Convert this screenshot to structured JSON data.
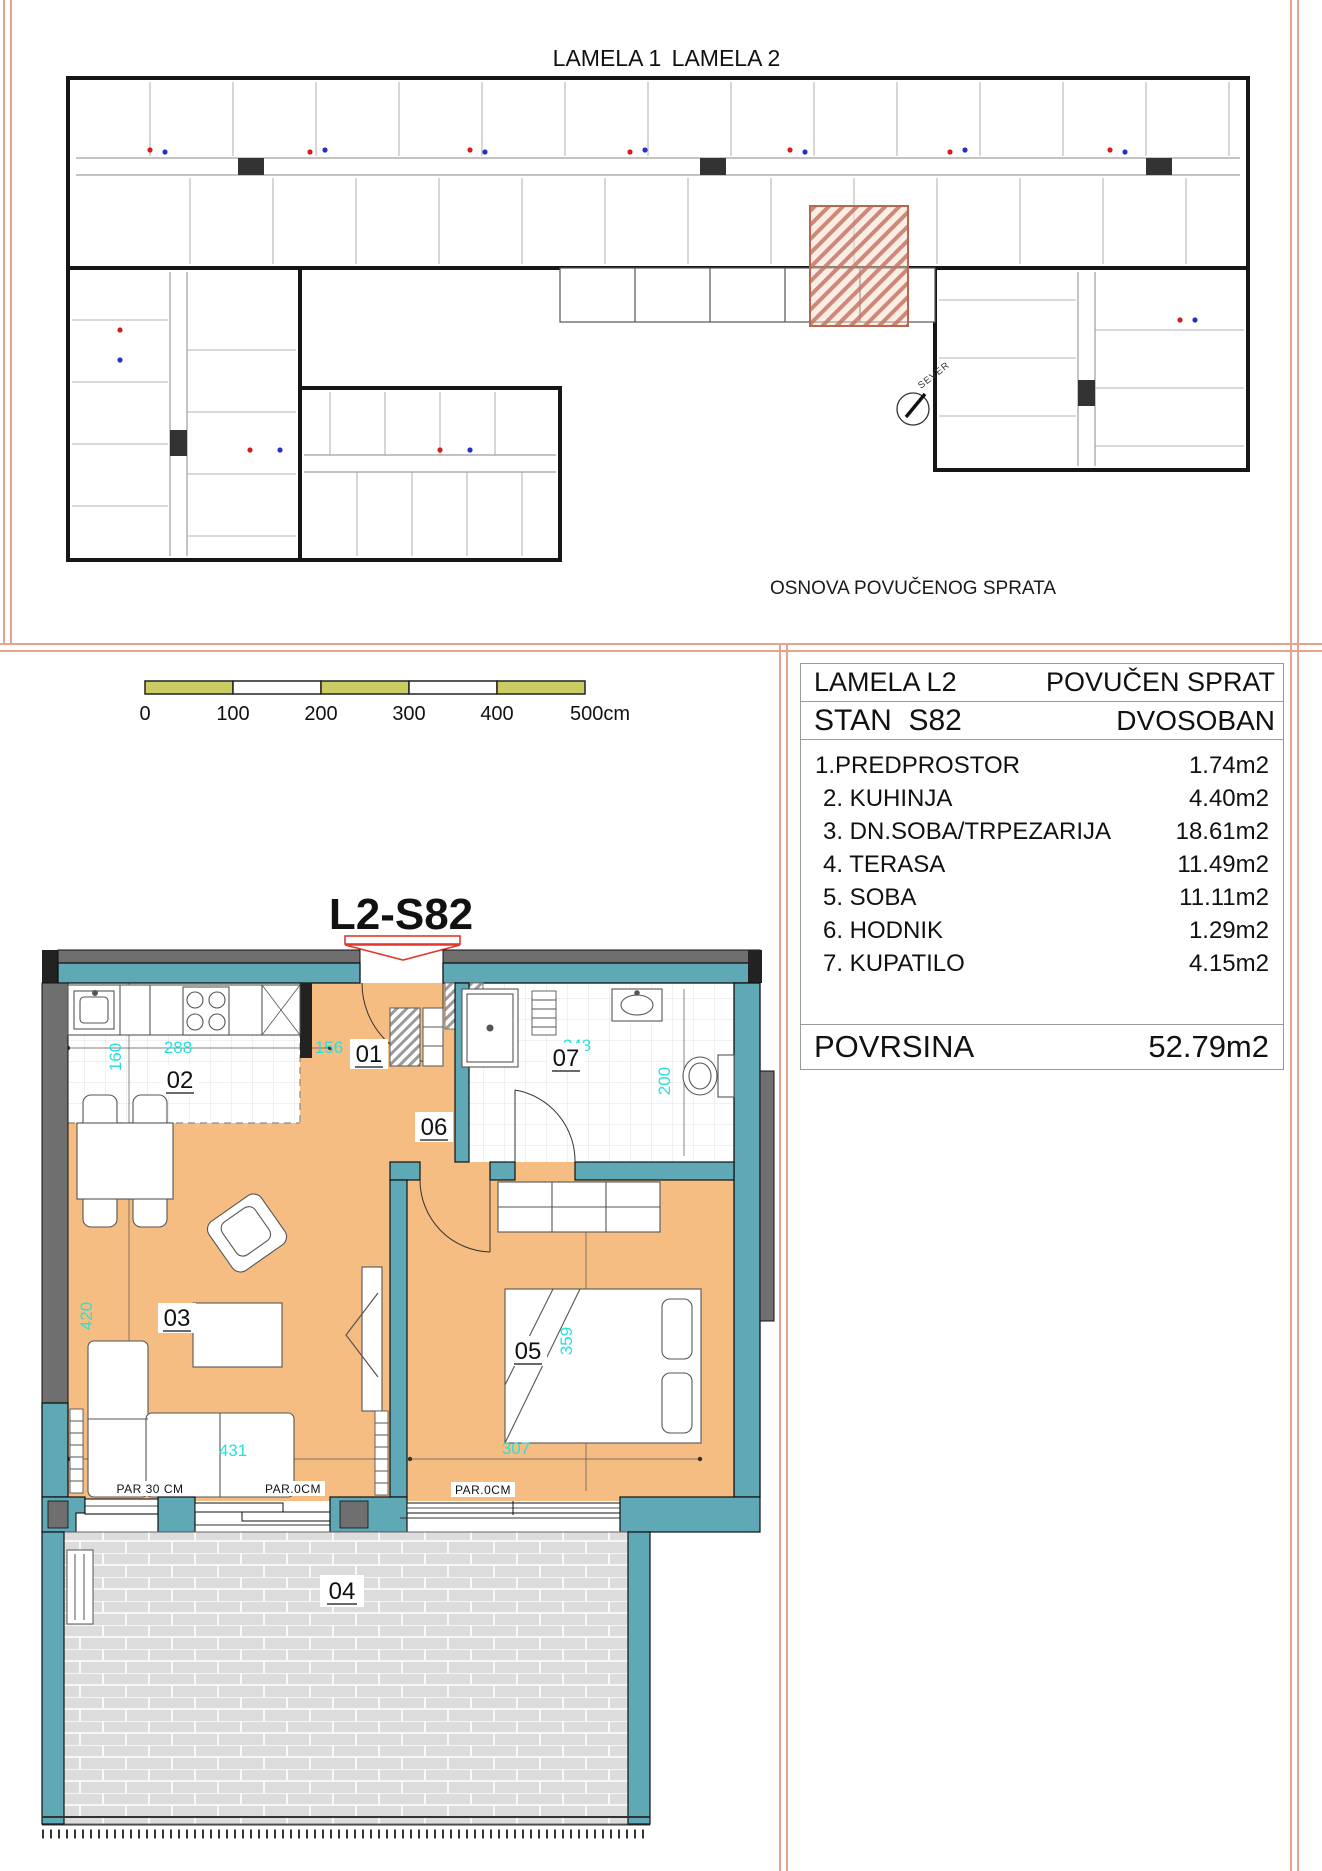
{
  "page": {
    "accent_border_color": "#e8a28c"
  },
  "overview": {
    "lamela_labels": [
      "LAMELA 1",
      "LAMELA 2"
    ],
    "caption": "OSNOVA POVUČENOG SPRATA",
    "compass_label": "SEVER",
    "highlight_color": "#c4705a"
  },
  "scale_bar": {
    "labels": [
      "0",
      "100",
      "200",
      "300",
      "400",
      "500cm"
    ],
    "bar_color": "#c9cd63"
  },
  "unit_plan": {
    "title": "L2-S82",
    "room_numbers": {
      "r1": "01",
      "r2": "02",
      "r3": "03",
      "r4": "04",
      "r5": "05",
      "r6": "06",
      "r7": "07"
    },
    "dimensions": {
      "kitchen_depth": "160",
      "kitchen_width": "288",
      "entry": "156",
      "bath_width": "248",
      "bath_depth": "200",
      "living_height": "420",
      "living_width": "431",
      "bedroom_width": "307",
      "bedroom_height": "359"
    },
    "window_labels": [
      "PAR 30 CM",
      "PAR.0CM",
      "PAR.0CM"
    ],
    "colors": {
      "wall_teal": "#5fa9b6",
      "floor_orange": "#f6bd82",
      "dimension_cyan": "#27e0e0",
      "door_red": "#e2382c"
    }
  },
  "info_table": {
    "title_left": "LAMELA L2",
    "title_right": "POVUČEN SPRAT",
    "subtitle_left": "STAN  S82",
    "subtitle_right": "DVOSOBAN",
    "rows": [
      {
        "label": "1.PREDPROSTOR",
        "area": "1.74m2"
      },
      {
        "label": "2. KUHINJA",
        "area": "4.40m2"
      },
      {
        "label": "3. DN.SOBA/TRPEZARIJA",
        "area": "18.61m2"
      },
      {
        "label": "4. TERASA",
        "area": "11.49m2"
      },
      {
        "label": "5. SOBA",
        "area": "11.11m2"
      },
      {
        "label": "6. HODNIK",
        "area": "1.29m2"
      },
      {
        "label": "7. KUPATILO",
        "area": "4.15m2"
      }
    ],
    "total_label": "POVRSINA",
    "total_area": "52.79m2"
  }
}
